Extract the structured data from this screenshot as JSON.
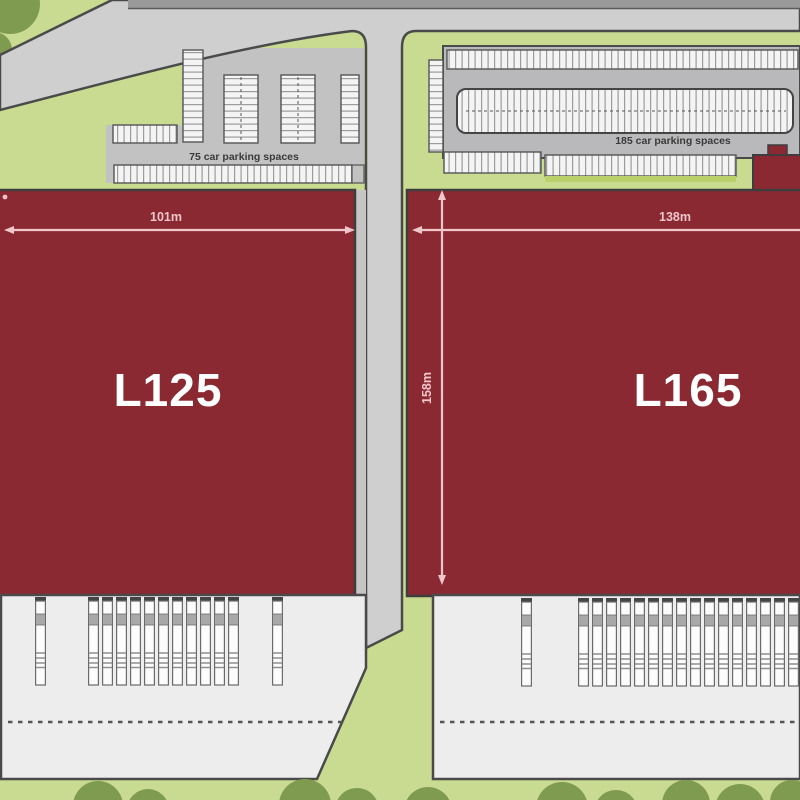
{
  "plan": {
    "buildings": {
      "left": {
        "label": "L125",
        "width_dim": "101m"
      },
      "right": {
        "label": "L165",
        "width_dim": "138m",
        "depth_dim": "158m"
      }
    },
    "parking": {
      "left": {
        "label": "75 car parking spaces"
      },
      "right": {
        "label": "185 car parking spaces"
      }
    },
    "docks": {
      "left_trucks_x": [
        35,
        88,
        102,
        116,
        130,
        144,
        158,
        172,
        186,
        200,
        214,
        228,
        272
      ],
      "right_trucks_x": [
        521,
        578,
        592,
        606,
        620,
        634,
        648,
        662,
        676,
        690,
        704,
        718,
        732,
        746,
        760,
        774,
        788
      ]
    },
    "colors": {
      "landscape_green": "#C9DB90",
      "tree_green": "#7E9B50",
      "road_gray": "#CFCFCF",
      "road_top_strip": "#9A9A9A",
      "curb_dark": "#4A4A4A",
      "asphalt_gray": "#C2C2C3",
      "lot_gray": "#B9B9BB",
      "space_white": "#F4F4F4",
      "building_red": "#8B2932",
      "building_outline": "#3E3E3E",
      "dimension_pink": "#EFC6C9",
      "yard_gray": "#EDEDED",
      "label_dark": "#3A3A3A",
      "label_white": "#FFFFFF",
      "hedge_green": "#BBD06A"
    }
  }
}
